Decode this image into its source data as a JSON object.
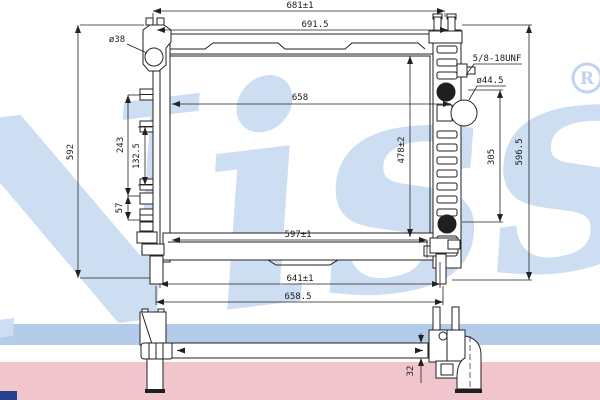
{
  "watermark": {
    "brand_script": "Nissens",
    "registered_mark": "R",
    "script_color": "#cddef2",
    "stripe_blue": "#b3cce9",
    "stripe_pink": "#f0c5cb",
    "corner_bar_color": "#27418e"
  },
  "drawing": {
    "line_color": "#222222",
    "dims": {
      "top_width_outer": "681±1",
      "top_width_tank": "691.5",
      "core_width": "658",
      "core_width_bottom": "597±1",
      "bottom_width_inner": "641±1",
      "bottom_width_outer": "658.5",
      "overall_height_left": "592",
      "bracket_span": "243",
      "bracket_span_inner": "132.5",
      "bracket_offset": "57",
      "core_height": "478±2",
      "port_span": "305",
      "overall_height_right": "596.5",
      "inlet_thread": "5/8-18UNF",
      "inlet_port_dia": "ø44.5",
      "mount_hole_dia": "ø38",
      "tank_depth": "32"
    }
  }
}
